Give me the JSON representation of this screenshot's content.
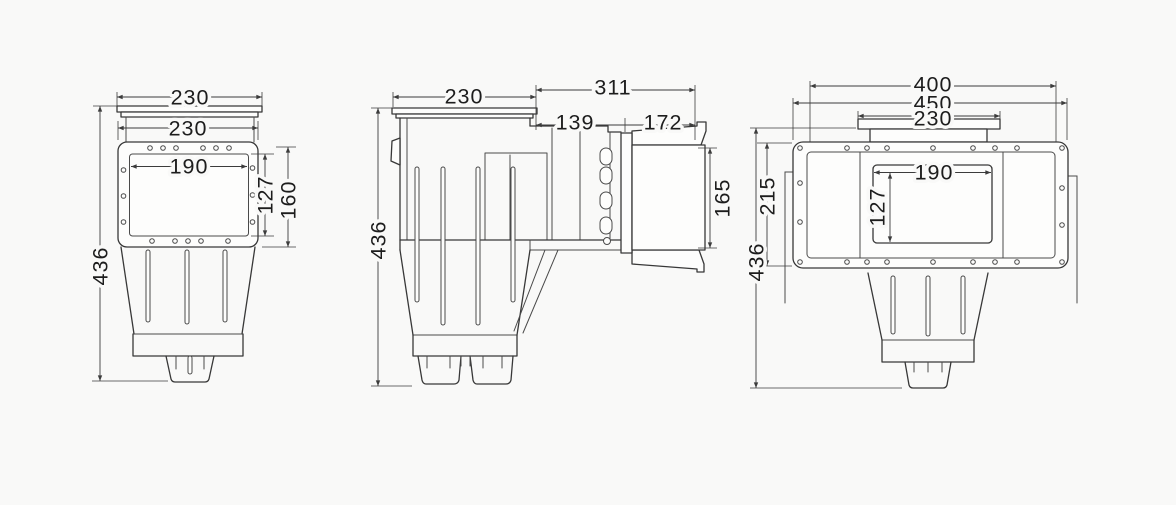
{
  "drawing": {
    "type": "technical-drawing",
    "views": {
      "front": {
        "name": "front-view",
        "dims": {
          "lid_width": "230",
          "faceplate_width": "230",
          "window_width": "190",
          "window_height": "127",
          "faceplate_height": "160",
          "overall_height": "436"
        }
      },
      "side": {
        "name": "side-view",
        "dims": {
          "tank_depth": "230",
          "overall_depth": "311",
          "throat_depth": "139",
          "faceplate_depth": "172",
          "faceplate_height": "165",
          "overall_height": "436"
        }
      },
      "rear": {
        "name": "rear-view",
        "dims": {
          "bolt_span": "400",
          "plate_width": "450",
          "lid_width": "230",
          "window_width": "190",
          "window_height": "127",
          "plate_height": "215",
          "overall_height": "436"
        }
      }
    },
    "colors": {
      "background": "#f9f9f8",
      "line": "#383838",
      "dimension_line": "#3c3c3c",
      "text": "#1d1d1d"
    }
  }
}
